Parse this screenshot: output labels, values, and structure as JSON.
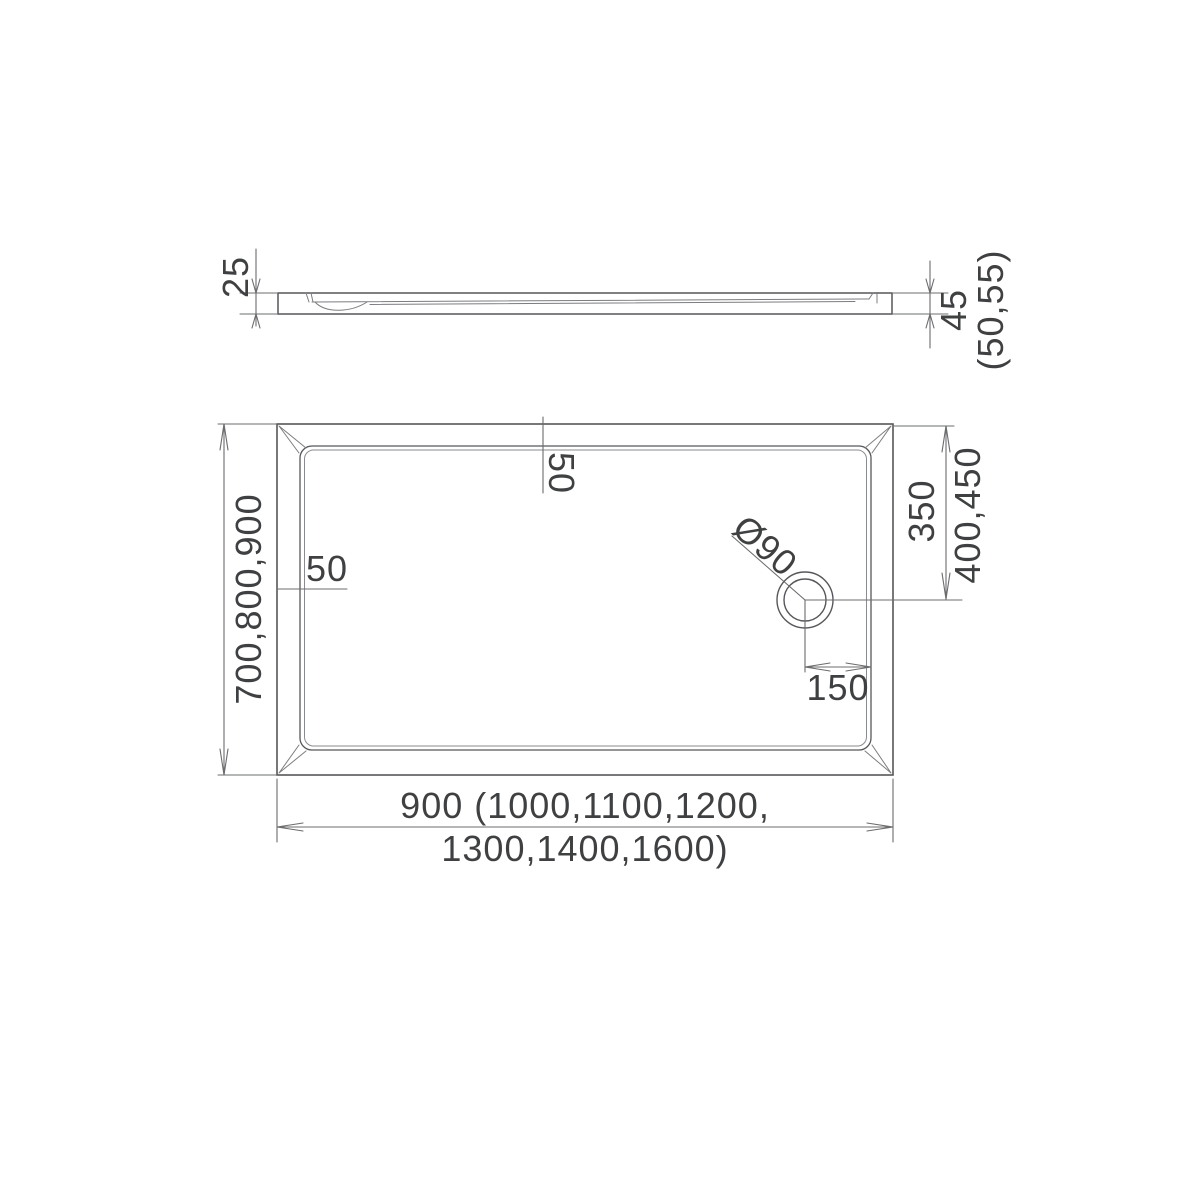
{
  "drawing": {
    "type": "technical-dimension-drawing",
    "subject": "rectangular shower tray with corner drain, side elevation and plan view",
    "colors": {
      "background": "#ffffff",
      "object_line": "#56575a",
      "dimension_line": "#6b6c6e",
      "text": "#3f4042"
    },
    "labels": {
      "side_rim_height": "25",
      "side_total_height": "45",
      "side_total_height_variants": "(50,55)",
      "plan_width": "700,800,900",
      "rim_width_top": "50",
      "rim_width_left": "50",
      "drain_diameter": "Ø90",
      "drain_offset_from_top": "350",
      "drain_offset_from_top_variants": "400,450",
      "drain_offset_from_right_edge": "150",
      "plan_length_line1": "900 (1000,1100,1200,",
      "plan_length_line2": "1300,1400,1600)"
    }
  }
}
